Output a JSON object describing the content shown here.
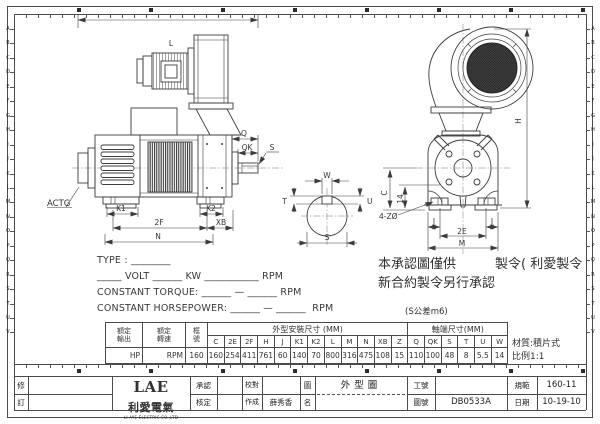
{
  "colors": {
    "line": "#3c3c3c",
    "text": "#2f2f2f"
  },
  "ruler": {
    "letters": "ABCDEFGHIJKLMNOPQRSTUV"
  },
  "drawing": {
    "side": {
      "l": "L",
      "actg": "ACTG",
      "k1": "K1",
      "k2": "K2",
      "f2": "2F",
      "xb": "XB",
      "n": "N",
      "q": "Q",
      "qk": "QK",
      "s": "S"
    },
    "section": {
      "w": "W",
      "t": "T",
      "u": "U",
      "s": "S"
    },
    "end": {
      "h": "H",
      "c": "C",
      "d14": "14",
      "holes": "4-ZØ",
      "j_left": "J",
      "j_right": "J",
      "e2": "2E",
      "m": "M"
    }
  },
  "spec_lines": {
    "type": "TYPE : ________",
    "volt": "_____ VOLT ______ KW ___________ RPM",
    "torque": "CONSTANT TORQUE: ______ — ______ RPM",
    "horsepower": "CONSTANT HORSEPOWER: ______ — ______  RPM"
  },
  "notes": {
    "line1": "本承認圖僅供　　　製令( 利愛製令",
    "line2": "新合約製令另行承認",
    "tolerance": "(S公差m6)",
    "material": "材質:積片式",
    "scale": "比例1:1"
  },
  "table": {
    "rated_output_label": "額定\n輸出",
    "rated_speed_label": "額定\n轉速",
    "frame_label": "框\n號",
    "outline_group_label": "外型安裝尺寸 (MM)",
    "shaft_group_label": "軸端尺寸(MM)",
    "outline_columns": [
      "C",
      "2E",
      "2F",
      "H",
      "J",
      "K1",
      "K2",
      "L",
      "M",
      "N",
      "XB",
      "Z"
    ],
    "outline_values": [
      "160",
      "254",
      "411",
      "761",
      "60",
      "140",
      "70",
      "800",
      "316",
      "475",
      "108",
      "15"
    ],
    "shaft_columns": [
      "Q",
      "QK",
      "S",
      "T",
      "U",
      "W"
    ],
    "shaft_values": [
      "110",
      "100",
      "48",
      "8",
      "5.5",
      "14"
    ],
    "rated_output_value": "HP",
    "rated_speed_value": "RPM",
    "frame_value": "160"
  },
  "title_block": {
    "revision_top": "修",
    "revision_bottom": "訂",
    "logo_lae": "LAE",
    "logo_cn": "利愛電氣",
    "logo_en": "LI AYE ELECTRIC CO.,LTD",
    "approve_label": "承認",
    "check_label": "核定",
    "proof_label": "校對",
    "made_label": "作成",
    "made_value": "薛秀香",
    "name_label_top": "圖",
    "name_label_bottom": "名",
    "drawing_name": "外型圖",
    "work_no_label": "工號",
    "work_no_value": "",
    "dwg_no_label": "圖號",
    "dwg_no_value": "DB0533A",
    "spec_label": "規範",
    "spec_value": "160-11",
    "date_label": "日期",
    "date_value": "10-19-10"
  }
}
